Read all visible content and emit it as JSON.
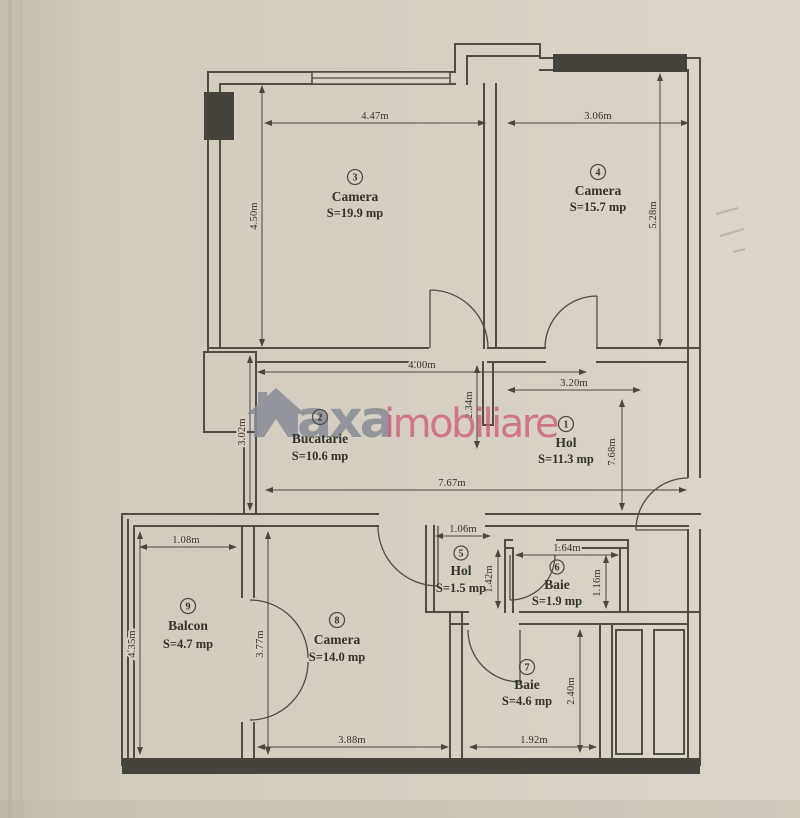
{
  "watermark": {
    "logo": "house-icon",
    "text_gray": "axa",
    "text_pink": "imobiliare"
  },
  "rooms": [
    {
      "number": "1",
      "name": "Hol",
      "area": "S=11.3 mp"
    },
    {
      "number": "2",
      "name": "Bucatarie",
      "area": "S=10.6 mp"
    },
    {
      "number": "3",
      "name": "Camera",
      "area": "S=19.9 mp"
    },
    {
      "number": "4",
      "name": "Camera",
      "area": "S=15.7 mp"
    },
    {
      "number": "5",
      "name": "Hol",
      "area": "S=1.5 mp"
    },
    {
      "number": "6",
      "name": "Baie",
      "area": "S=1.9 mp"
    },
    {
      "number": "7",
      "name": "Baie",
      "area": "S=4.6 mp"
    },
    {
      "number": "8",
      "name": "Camera",
      "area": "S=14.0 mp"
    },
    {
      "number": "9",
      "name": "Balcon",
      "area": "S=4.7 mp"
    }
  ],
  "dims": {
    "d447": "4.47m",
    "d306": "3.06m",
    "d450": "4.50m",
    "d528": "5.28m",
    "d400": "4.00m",
    "d320": "3.20m",
    "d302": "3.02m",
    "d234": "2.34m",
    "d767": "7.67m",
    "d768": "7.68m",
    "d108": "1.08m",
    "d106": "1.06m",
    "d164": "1.64m",
    "d142": "1.42m",
    "d116": "1.16m",
    "d435": "4.35m",
    "d377": "3.77m",
    "d240": "2.40m",
    "d388": "3.88m",
    "d192": "1.92m"
  },
  "colors": {
    "paper": "#d4cdc0",
    "wall": "#514d45",
    "watermark_gray": "#878d96",
    "watermark_pink": "#cf5f7a"
  }
}
